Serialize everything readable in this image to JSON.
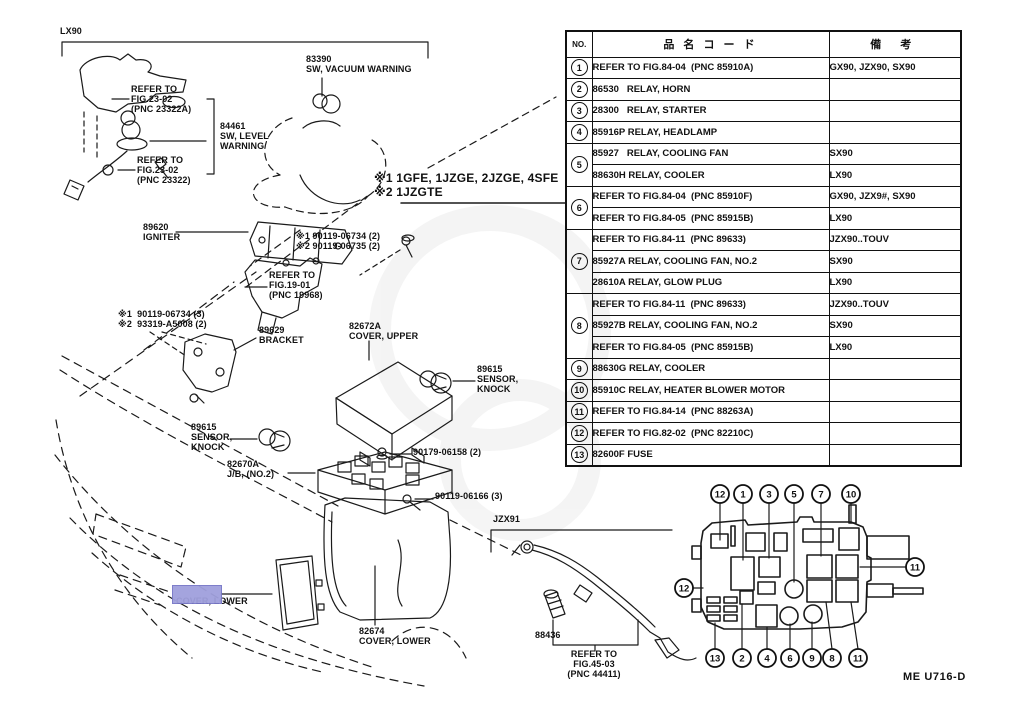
{
  "page": {
    "figure_code": "ME U716-D"
  },
  "table": {
    "headers": {
      "no": "NO.",
      "name": "品 名 コ ー ド",
      "remarks": "備  考"
    },
    "rows": [
      {
        "no": "1",
        "rowspan": 1,
        "desc": "REFER TO FIG.84-04  (PNC 85910A)",
        "remark": "GX90, JZX90, SX90"
      },
      {
        "no": "2",
        "rowspan": 1,
        "desc": "86530   RELAY, HORN",
        "remark": ""
      },
      {
        "no": "3",
        "rowspan": 1,
        "desc": "28300   RELAY, STARTER",
        "remark": ""
      },
      {
        "no": "4",
        "rowspan": 1,
        "desc": "85916P RELAY, HEADLAMP",
        "remark": ""
      },
      {
        "no": "5",
        "rowspan": 2,
        "desc": "85927   RELAY, COOLING FAN",
        "remark": "SX90"
      },
      {
        "desc": "88630H RELAY, COOLER",
        "remark": "LX90"
      },
      {
        "no": "6",
        "rowspan": 2,
        "desc": "REFER TO FIG.84-04  (PNC 85910F)",
        "remark": "GX90, JZX9#, SX90"
      },
      {
        "desc": "REFER TO FIG.84-05  (PNC 85915B)",
        "remark": "LX90"
      },
      {
        "no": "7",
        "rowspan": 3,
        "desc": "REFER TO FIG.84-11  (PNC 89633)",
        "remark": "JZX90..TOUV"
      },
      {
        "desc": "85927A RELAY, COOLING FAN, NO.2",
        "remark": "SX90"
      },
      {
        "desc": "28610A RELAY, GLOW PLUG",
        "remark": "LX90"
      },
      {
        "no": "8",
        "rowspan": 3,
        "desc": "REFER TO FIG.84-11  (PNC 89633)",
        "remark": "JZX90..TOUV"
      },
      {
        "desc": "85927B RELAY, COOLING FAN, NO.2",
        "remark": "SX90"
      },
      {
        "desc": "REFER TO FIG.84-05  (PNC 85915B)",
        "remark": "LX90"
      },
      {
        "no": "9",
        "rowspan": 1,
        "desc": "88630G RELAY, COOLER",
        "remark": ""
      },
      {
        "no": "10",
        "rowspan": 1,
        "desc": "85910C RELAY, HEATER BLOWER MOTOR",
        "remark": ""
      },
      {
        "no": "11",
        "rowspan": 1,
        "desc": "REFER TO FIG.84-14  (PNC 88263A)",
        "remark": ""
      },
      {
        "no": "12",
        "rowspan": 1,
        "desc": "REFER TO FIG.82-02  (PNC 82210C)",
        "remark": ""
      },
      {
        "no": "13",
        "rowspan": 1,
        "desc": "82600F FUSE",
        "remark": ""
      }
    ]
  },
  "diagram": {
    "highlight_color": "#a0a0dd",
    "labels": {
      "lx90": "LX90",
      "refer_2302a": "REFER TO\nFIG.23-02\n(PNC 23322A)",
      "sw_level": "84461\nSW, LEVEL\nWARNING",
      "refer_2302": "REFER TO\nFIG.23-02\n(PNC 23322)",
      "sw_vacuum": "83390\nSW, VACUUM WARNING",
      "eng1": "※1 1GFE, 1JZGE, 2JZGE, 4SFE",
      "eng2": "※2 1JZGTE",
      "igniter": "89620\nIGNITER",
      "bolts_a": "※1 90119-06734 (2)\n※2 90119-06735 (2)",
      "refer_1901": "REFER TO\nFIG.19-01\n(PNC 19968)",
      "bolts_b": "※1  90119-06734 (3)\n※2  93319-A5008 (2)",
      "bracket89629": "89629\nBRACKET",
      "cover_upper": "82672A\nCOVER, UPPER",
      "knock_r": "89615\nSENSOR,\nKNOCK",
      "knock_l": "89615\nSENSOR,\nKNOCK",
      "jb_no2": "82670A\nJ/B, (NO.2)",
      "bolt_90179": "90179-06158 (2)",
      "bolt_90119": "90119-06166 (3)",
      "jzx91": "JZX91",
      "cover_lower_main": "COVER, LOWER",
      "cover_lower_82674": "82674\nCOVER, LOWER",
      "s88436": "88436",
      "refer_4503": "REFER TO\nFIG.45-03\n(PNC 44411)"
    }
  },
  "fusebox": {
    "callouts": [
      {
        "n": "12",
        "x": 720,
        "y": 494
      },
      {
        "n": "1",
        "x": 743,
        "y": 494
      },
      {
        "n": "3",
        "x": 769,
        "y": 494
      },
      {
        "n": "5",
        "x": 794,
        "y": 494
      },
      {
        "n": "7",
        "x": 821,
        "y": 494
      },
      {
        "n": "10",
        "x": 851,
        "y": 494
      },
      {
        "n": "13",
        "x": 715,
        "y": 658
      },
      {
        "n": "2",
        "x": 742,
        "y": 658
      },
      {
        "n": "4",
        "x": 767,
        "y": 658
      },
      {
        "n": "6",
        "x": 790,
        "y": 658
      },
      {
        "n": "9",
        "x": 812,
        "y": 658
      },
      {
        "n": "8",
        "x": 832,
        "y": 658
      },
      {
        "n": "11",
        "x": 858,
        "y": 658
      },
      {
        "n": "12",
        "x": 684,
        "y": 588
      },
      {
        "n": "11",
        "x": 915,
        "y": 567
      }
    ]
  }
}
